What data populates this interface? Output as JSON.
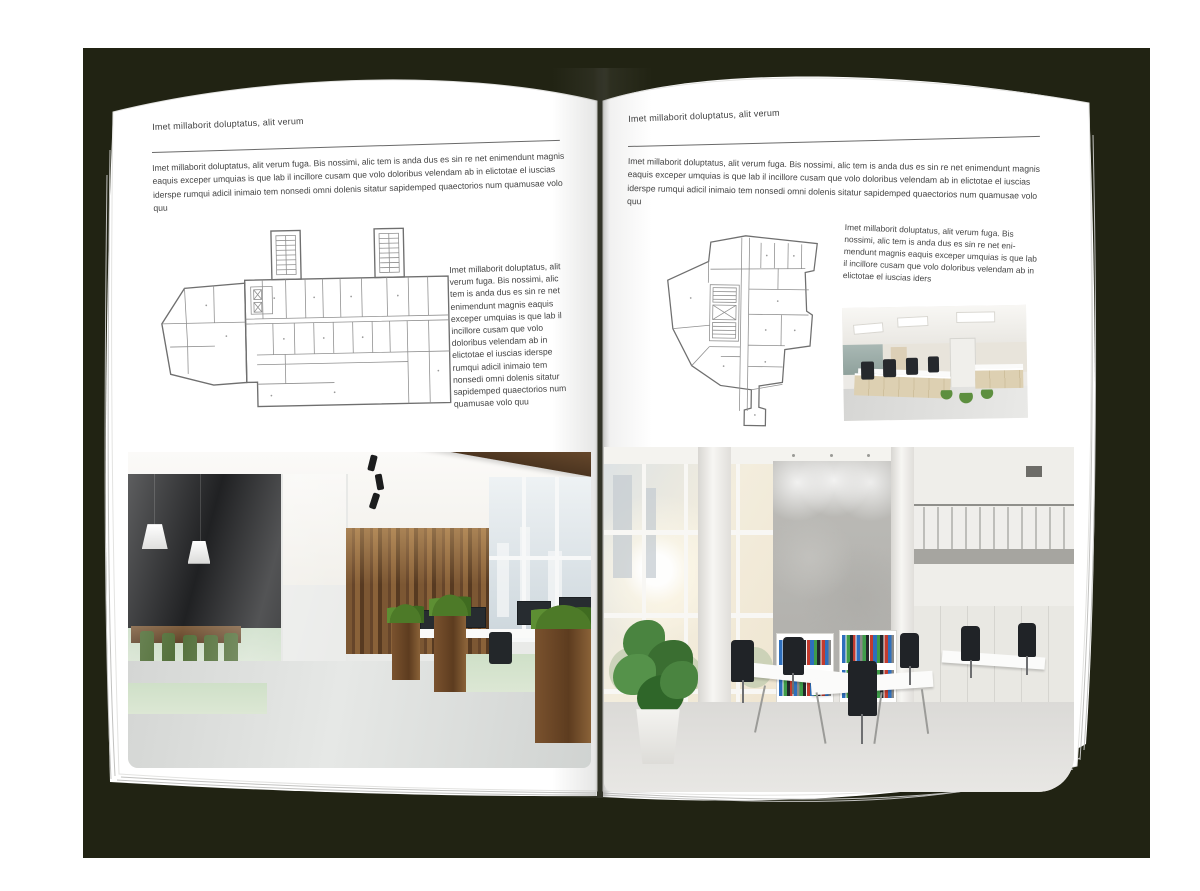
{
  "pages": {
    "left": {
      "kicker": "Imet millaborit doluptatus, alit verum",
      "intro": "Imet millaborit doluptatus, alit verum fuga. Bis nossimi, alic tem is anda dus es sin re net enimendunt magnis eaquis exceper umquias is que lab il incillore cusam que volo doloribus velendam ab in elictotae el iuscias iderspe rumqui adicil inimaio tem nonsedi omni dolenis sitatur sapidemped quaectorios num quamusae volo quu",
      "aside": "Imet millaborit doluptatus, alit verum fuga. Bis nossimi, alic tem is anda dus es sin re net enimendunt magnis eaquis exceper umquias is que lab il incillore cusam que volo doloribus velendam ab in elictotae el iuscias iderspe rumqui adicil inimaio tem nonsedi omni dolenis sitatur sapidemped quaectorios num quamusae volo quu"
    },
    "right": {
      "kicker": "Imet millaborit doluptatus, alit verum",
      "intro": "Imet millaborit doluptatus, alit verum fuga. Bis nossimi, alic tem is anda dus es sin re net enimendunt magnis eaquis exceper umquias is que lab il incillore cusam que volo doloribus velendam ab in elictotae el iuscias iderspe rumqui adicil inimaio tem nonsedi omni dolenis sitatur sapidemped quaectorios num quamusae volo quu",
      "aside": "Imet millaborit doluptatus, alit verum fuga. Bis nossimi, alic tem is anda dus es sin re net eni- mendunt magnis eaquis exceper umquias is que lab il incillore cusam que volo doloribus velendam ab in elictotae el iuscias iders"
    }
  },
  "colors": {
    "backdrop": "#212313",
    "page": "#ffffff",
    "text": "#444444",
    "rule": "#6a6a6a"
  }
}
